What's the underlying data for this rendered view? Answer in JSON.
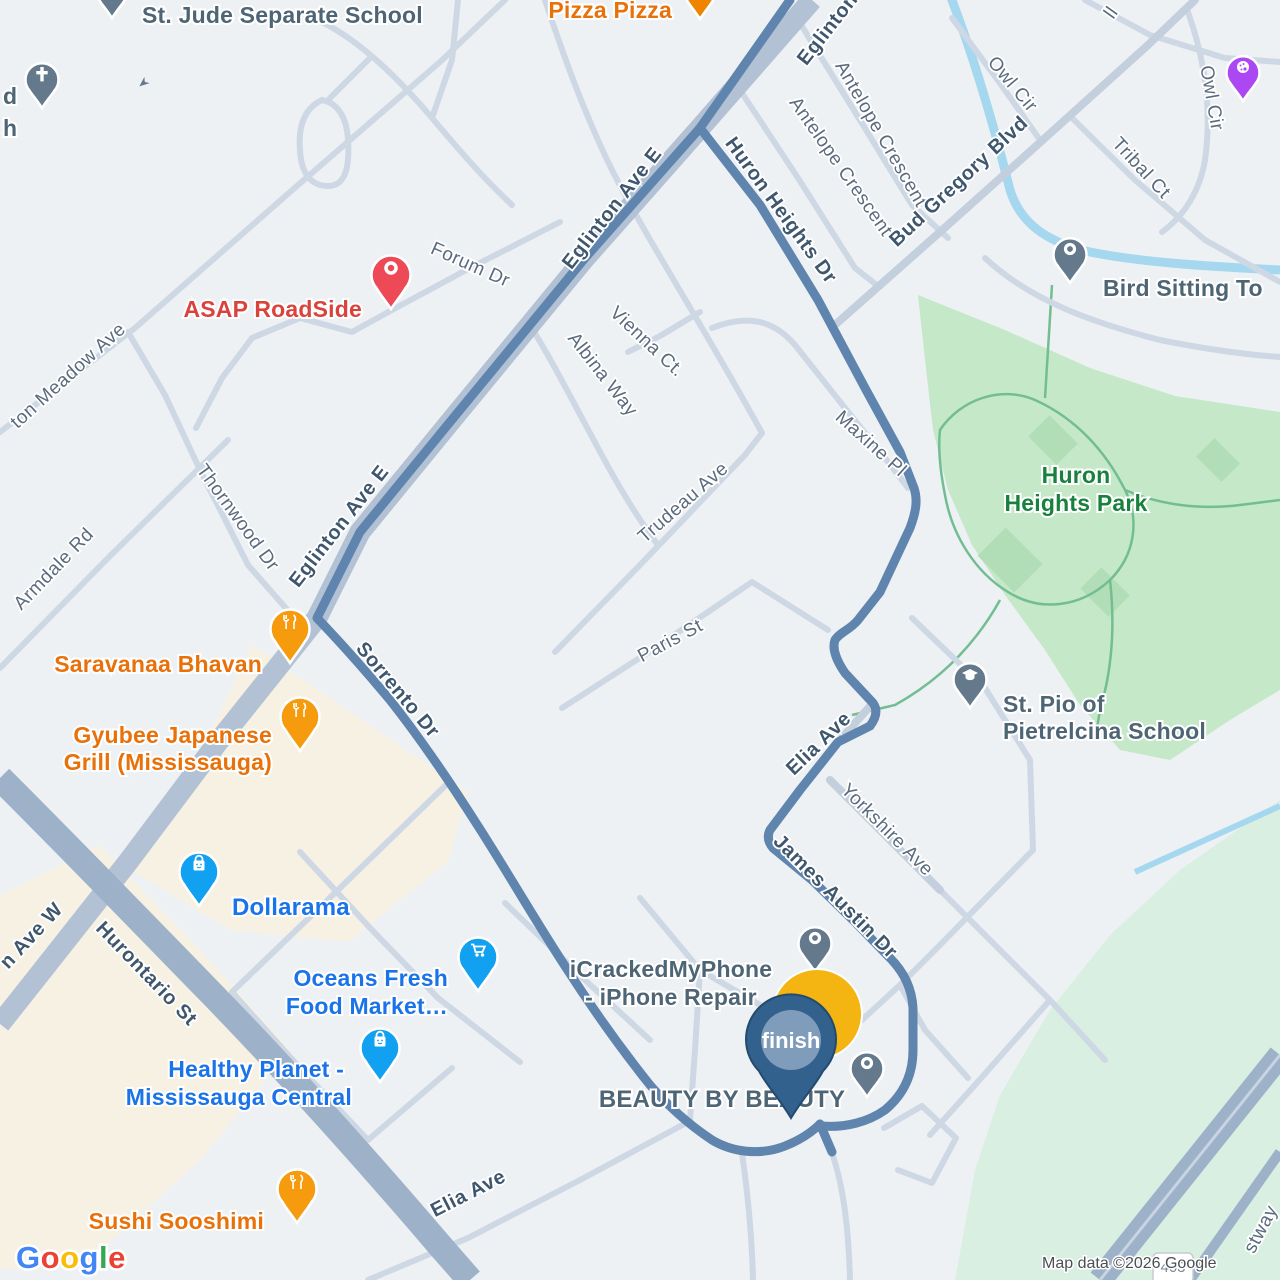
{
  "road_labels": [
    {
      "id": "eglinton-top",
      "text": "Eglinton Ave E"
    },
    {
      "id": "eglinton-mid",
      "text": "Eglinton Ave E"
    },
    {
      "id": "eglinton-low",
      "text": "Eglinton Ave E"
    },
    {
      "id": "eglinton-w-fragment",
      "text": "n Ave W"
    },
    {
      "id": "hurontario",
      "text": "Hurontario St"
    },
    {
      "id": "forum",
      "text": "Forum Dr"
    },
    {
      "id": "huron-heights",
      "text": "Huron Heights Dr"
    },
    {
      "id": "antelope-1",
      "text": "Antelope Crescent"
    },
    {
      "id": "antelope-2",
      "text": "Antelope Crescent"
    },
    {
      "id": "bud-gregory",
      "text": "Bud Gregory Blvd"
    },
    {
      "id": "owl-cir-1",
      "text": "Owl Cir"
    },
    {
      "id": "owl-cir-2",
      "text": "Owl Cir"
    },
    {
      "id": "tribal",
      "text": "Tribal Ct"
    },
    {
      "id": "top-right-fragment",
      "text": "ll"
    },
    {
      "id": "vienna",
      "text": "Vienna Ct."
    },
    {
      "id": "albina",
      "text": "Albina Way"
    },
    {
      "id": "trudeau",
      "text": "Trudeau Ave"
    },
    {
      "id": "maxine",
      "text": "Maxine Pl"
    },
    {
      "id": "paris",
      "text": "Paris St"
    },
    {
      "id": "elia-route",
      "text": "Elia Ave"
    },
    {
      "id": "yorkshire",
      "text": "Yorkshire Ave"
    },
    {
      "id": "james-austin",
      "text": "James Austin Dr"
    },
    {
      "id": "sorrento",
      "text": "Sorrento Dr"
    },
    {
      "id": "thornwood",
      "text": "Thornwood Dr"
    },
    {
      "id": "meadow-fragment",
      "text": "ton Meadow Ave"
    },
    {
      "id": "armdale",
      "text": "Armdale Rd"
    },
    {
      "id": "elia-bottom",
      "text": "Elia Ave"
    },
    {
      "id": "eastway-fragment",
      "text": "stway"
    }
  ],
  "pois": {
    "st_jude": {
      "label": "St. Jude Separate School"
    },
    "church_fragment": {
      "lines": [
        "d",
        "h"
      ]
    },
    "pizza": {
      "label": "Pizza Pizza"
    },
    "asap": {
      "label": "ASAP RoadSide"
    },
    "bird": {
      "label": "Bird Sitting To"
    },
    "saravanaa": {
      "label": "Saravanaa Bhavan"
    },
    "gyubee": {
      "lines": [
        "Gyubee Japanese",
        "Grill (Mississauga)"
      ]
    },
    "dollarama": {
      "label": "Dollarama"
    },
    "oceans": {
      "lines": [
        "Oceans Fresh",
        "Food Market…"
      ]
    },
    "healthy": {
      "lines": [
        "Healthy Planet -",
        "Mississauga Central"
      ]
    },
    "sushi": {
      "label": "Sushi Sooshimi"
    },
    "icracked": {
      "lines": [
        "iCrackedMyPhone",
        "- iPhone Repair"
      ]
    },
    "beauty": {
      "label": "BEAUTY BY BEAUTY"
    },
    "st_pio": {
      "lines": [
        "St. Pio of",
        "Pietrelcina School"
      ]
    },
    "park": {
      "lines": [
        "Huron",
        "Heights Park"
      ]
    }
  },
  "markers": {
    "finish_label": "finish"
  },
  "misc": {
    "shield_403": "403",
    "attribution": "Map data ©2026 Google",
    "logo_letters": [
      "G",
      "o",
      "o",
      "g",
      "l",
      "e"
    ]
  },
  "colors": {
    "route": "#5f85ae",
    "water": "#a5d8ee",
    "park": "#c5e8c8",
    "greenspace": "#d9efe2",
    "commercial": "#f7f1e3",
    "major_road": "#9db1c9",
    "poi_orange": "#e8710a",
    "poi_blue": "#1a73e8",
    "poi_red": "#d9433c",
    "poi_slate": "#64798c",
    "poi_purple": "#ab47f3",
    "pin_blue": "#12a1f0",
    "pin_orange": "#f59b0d",
    "pin_red": "#ee4956",
    "finish_navy": "#31618c",
    "finish_yellow": "#f4b512"
  }
}
